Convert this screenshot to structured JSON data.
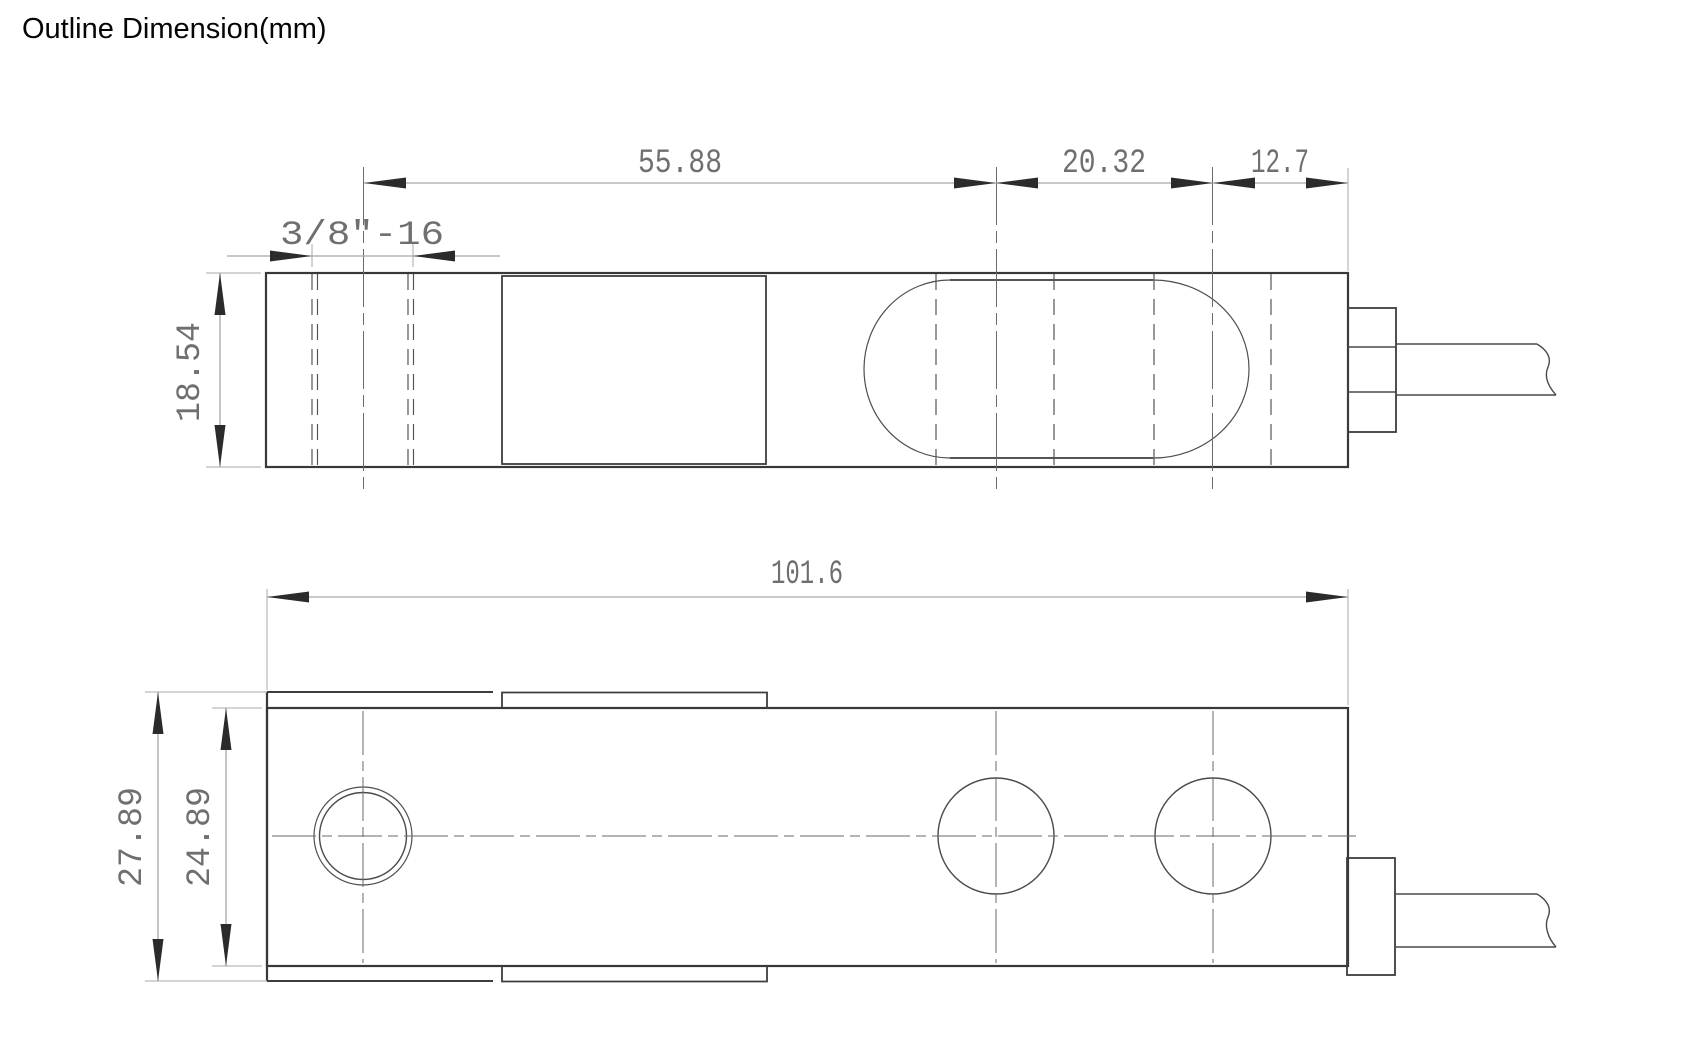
{
  "title": "Outline Dimension(mm)",
  "style": {
    "background": "#ffffff",
    "outline_color": "#383838",
    "dim_line_color": "#a8a8a8",
    "dim_text_color": "#6f6f6f"
  },
  "dimensions": {
    "side_view": {
      "thread_spec": "3/8″-16",
      "thread_to_first_hole": "55.88",
      "hole_spacing": "20.32",
      "hole_to_end": "12.7",
      "body_height": "18.54"
    },
    "plan_view": {
      "overall_length": "101.6",
      "overall_width": "27.89",
      "body_width": "24.89"
    }
  }
}
